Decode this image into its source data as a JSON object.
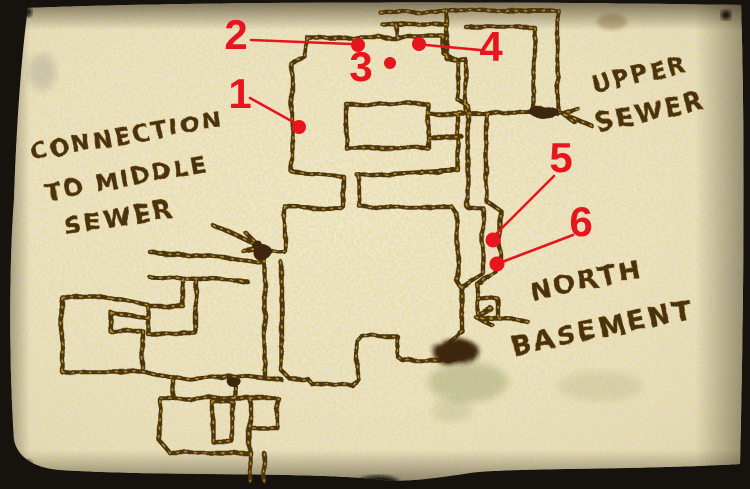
{
  "labels": {
    "connection_middle_sewer": {
      "line1": "CONNECTION",
      "line2": "TO MIDDLE",
      "line3": "SEWER"
    },
    "upper_sewer": {
      "line1": "UPPER",
      "line2": "SEWER"
    },
    "north_basement": {
      "line1": "NORTH",
      "line2": "BASEMENT"
    }
  },
  "markers": [
    {
      "number": "1",
      "dot": {
        "x": 299,
        "y": 127,
        "r": 7
      },
      "label": {
        "x": 240,
        "y": 108
      },
      "line": {
        "x1": 250,
        "y1": 98,
        "x2": 295,
        "y2": 123
      }
    },
    {
      "number": "2",
      "dot": {
        "x": 358,
        "y": 45,
        "r": 7
      },
      "label": {
        "x": 236,
        "y": 49
      },
      "line": {
        "x1": 251,
        "y1": 40,
        "x2": 351,
        "y2": 44
      }
    },
    {
      "number": "3",
      "dot": {
        "x": 390,
        "y": 63,
        "r": 6
      },
      "label": {
        "x": 361,
        "y": 81
      }
    },
    {
      "number": "4",
      "dot": {
        "x": 419,
        "y": 44,
        "r": 7
      },
      "label": {
        "x": 491,
        "y": 61
      },
      "line": {
        "x1": 480,
        "y1": 50,
        "x2": 426,
        "y2": 45
      }
    },
    {
      "number": "5",
      "dot": {
        "x": 493,
        "y": 240,
        "r": 7.5
      },
      "label": {
        "x": 561,
        "y": 172
      },
      "line": {
        "x1": 554,
        "y1": 176,
        "x2": 495,
        "y2": 235
      }
    },
    {
      "number": "6",
      "dot": {
        "x": 497,
        "y": 264,
        "r": 7.5
      },
      "label": {
        "x": 581,
        "y": 236
      },
      "line": {
        "x1": 573,
        "y1": 235,
        "x2": 502,
        "y2": 262
      }
    }
  ],
  "colors": {
    "annotation_red": "#e8151e",
    "ink_brown": "#4e350e",
    "ink_gold": "#c9a22c",
    "parchment": "#ddd8c4",
    "backdrop": "#16130e"
  }
}
